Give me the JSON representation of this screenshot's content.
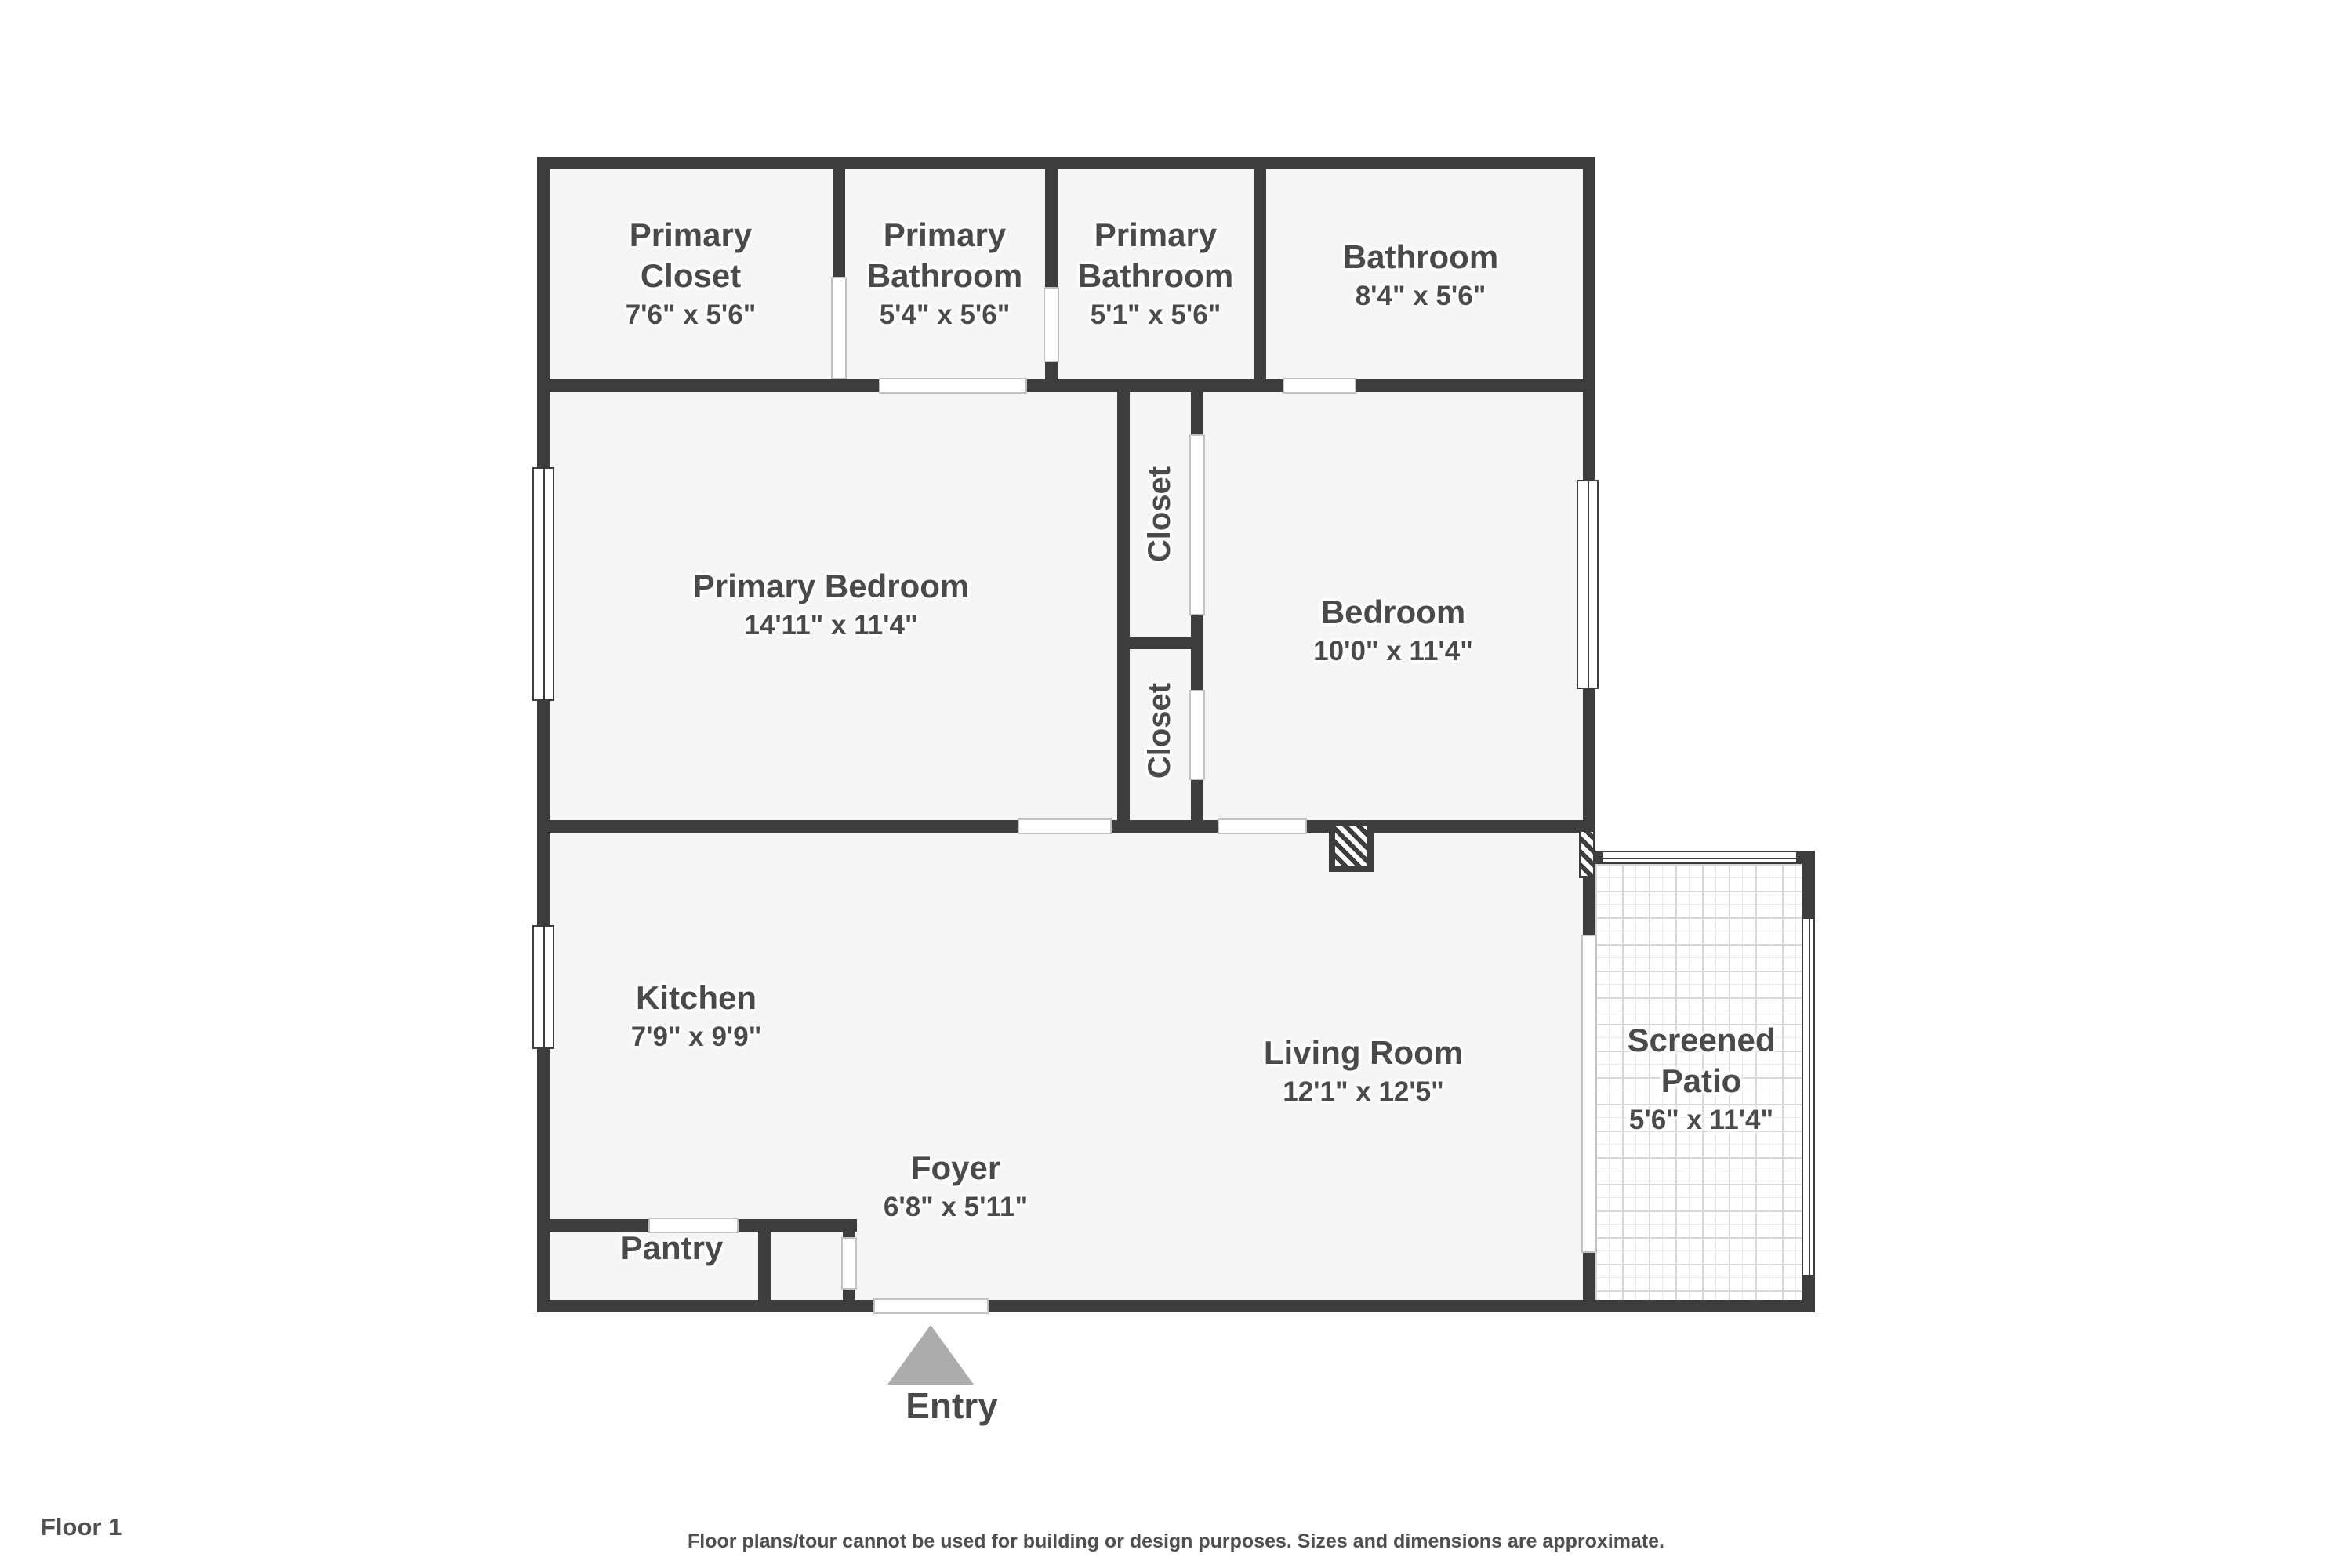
{
  "palette": {
    "wall": "#3d3d3d",
    "floor": "#f5f5f5",
    "label_text": "#4a4a4a",
    "entry_arrow": "#acacac",
    "tile_line": "#d8d8d8",
    "footer_text": "#4f4f4f"
  },
  "rooms": {
    "primary_closet": {
      "name": "Primary\nCloset",
      "dims": "7'6\" x 5'6\""
    },
    "primary_bathroom_1": {
      "name": "Primary\nBathroom",
      "dims": "5'4\" x 5'6\""
    },
    "primary_bathroom_2": {
      "name": "Primary\nBathroom",
      "dims": "5'1\" x 5'6\""
    },
    "bathroom": {
      "name": "Bathroom",
      "dims": "8'4\" x 5'6\""
    },
    "primary_bedroom": {
      "name": "Primary Bedroom",
      "dims": "14'11\" x 11'4\""
    },
    "bedroom": {
      "name": "Bedroom",
      "dims": "10'0\" x 11'4\""
    },
    "closet_upper": {
      "name": "Closet"
    },
    "closet_lower": {
      "name": "Closet"
    },
    "kitchen": {
      "name": "Kitchen",
      "dims": "7'9\" x 9'9\""
    },
    "living_room": {
      "name": "Living Room",
      "dims": "12'1\" x 12'5\""
    },
    "foyer": {
      "name": "Foyer",
      "dims": "6'8\" x 5'11\""
    },
    "pantry": {
      "name": "Pantry"
    },
    "screened_patio": {
      "name": "Screened\nPatio",
      "dims": "5'6\" x 11'4\""
    }
  },
  "entry": {
    "label": "Entry"
  },
  "footer": {
    "floor_label": "Floor 1",
    "disclaimer": "Floor plans/tour cannot be used for building or design purposes. Sizes and dimensions are approximate."
  }
}
